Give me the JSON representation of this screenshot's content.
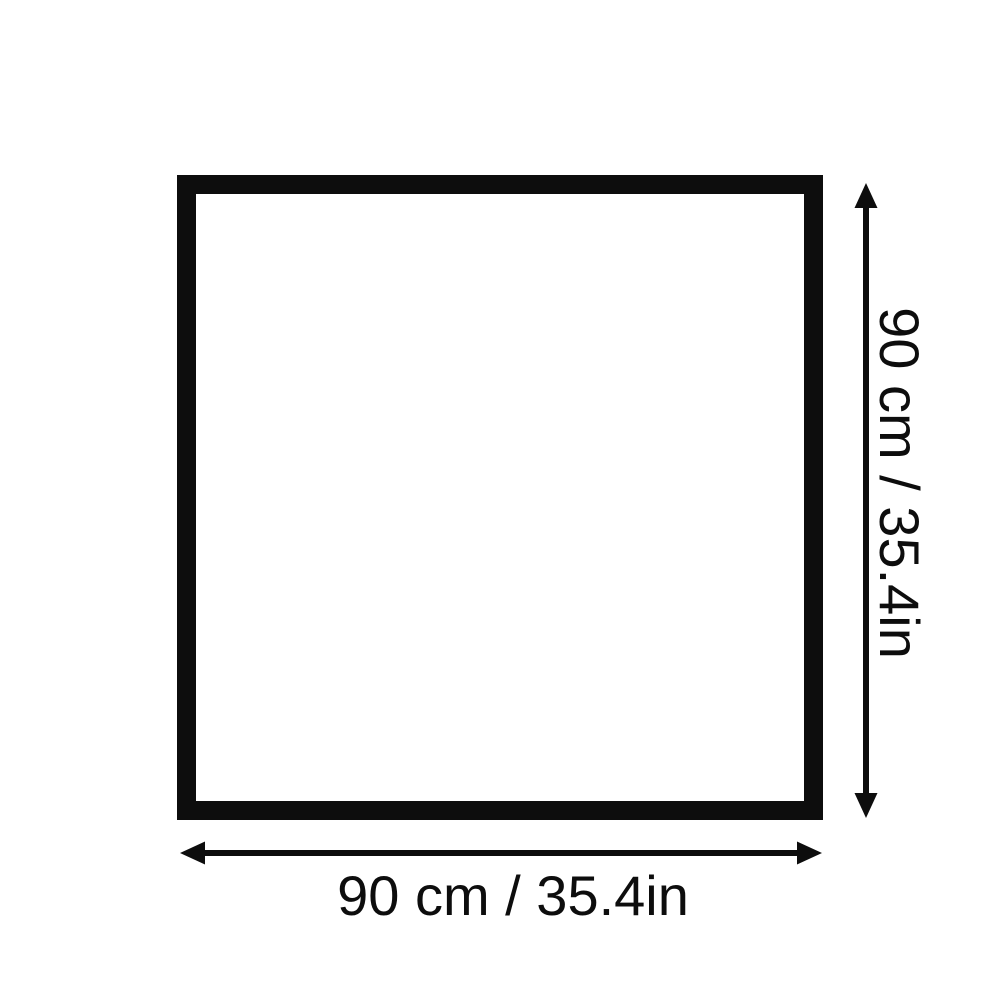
{
  "diagram": {
    "title": "square-dimension-diagram",
    "shape": "square",
    "height_label": "90 cm / 35.4in",
    "width_label": "90 cm / 35.4in"
  },
  "icons": {
    "vertical_arrow": "double-headed-arrow-vertical",
    "horizontal_arrow": "double-headed-arrow-horizontal"
  },
  "colors": {
    "foreground": "#0d0d0d",
    "background": "#ffffff"
  }
}
